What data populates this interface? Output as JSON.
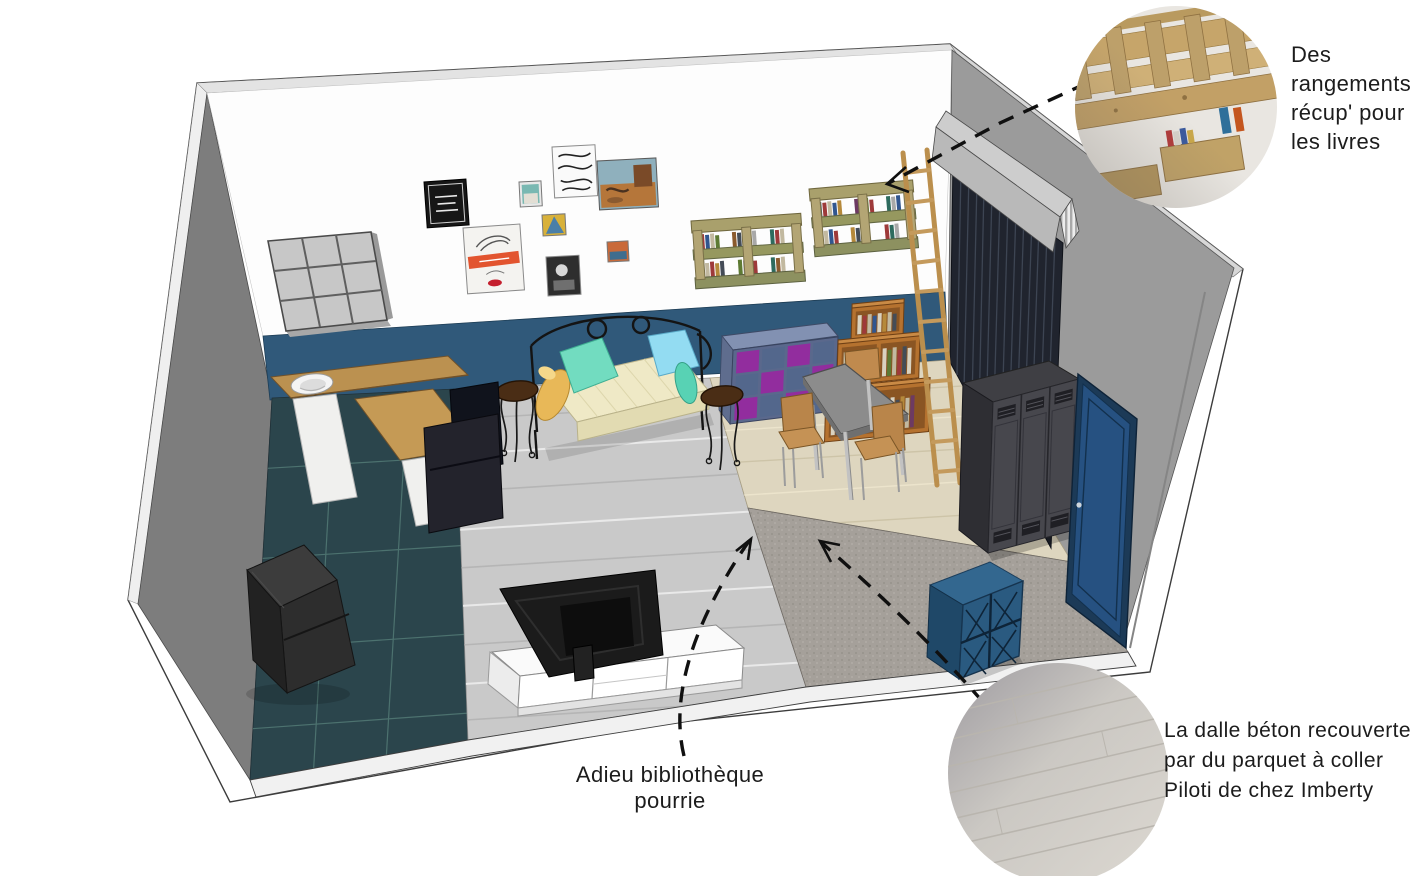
{
  "annotations": {
    "storage": {
      "line1": "Des",
      "line2": "rangements",
      "line3": "récup' pour",
      "line4": "les livres"
    },
    "floor": {
      "line1": "La dalle béton recouverte",
      "line2": "par du parquet à coller",
      "line3": "Piloti de chez Imberty"
    },
    "bookshelf_farewell": {
      "text": "Adieu bibliothèque pourrie"
    }
  },
  "palette": {
    "wainscot_blue": "#30597a",
    "tile_floor_teal": "#2b454c",
    "plank_floor_gray": "#c9c9c9",
    "parquet_beige": "#ded6bf",
    "carpet_gray": "#a5a09a",
    "cube_purple": "#922d9e",
    "cube_blue_gray": "#55688e",
    "navy_furniture": "#2c5d84",
    "door_navy": "#254a70",
    "wood": "#bb9150",
    "annotation_text": "#1c1c1c"
  },
  "scene_items": [
    "wall-cube-shelf",
    "gallery-frames",
    "pallet-book-shelves",
    "roller-shutter",
    "wood-ladder",
    "purple-cube-unit",
    "wood-bookshelf",
    "dining-table",
    "dining-chairs",
    "daybed",
    "bistro-tables",
    "kitchen-counter",
    "sink",
    "armchair",
    "wood-stove",
    "tv",
    "tv-cabinet",
    "metal-lockers",
    "entry-door",
    "blue-cube-shelf"
  ]
}
